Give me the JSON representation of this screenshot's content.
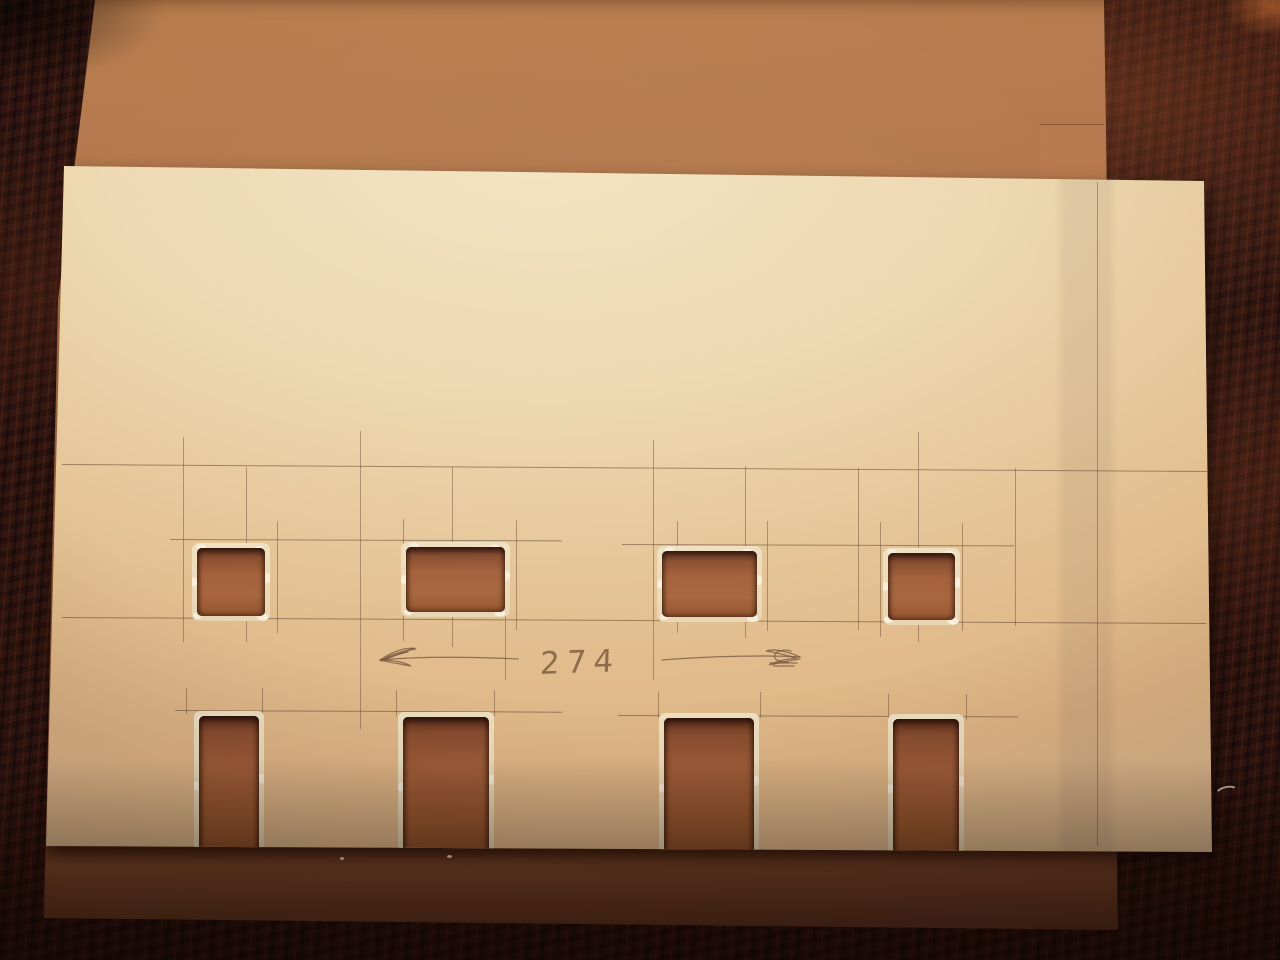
{
  "meta": {
    "type": "photograph",
    "subject": "Scratch-built model facade wall cut from a white styrene sheet, with four window openings and four door openings, lying on an MDF board on a dark wooden workbench"
  },
  "annotations": {
    "dimension_label": "274",
    "dimension_arrows": "pencil dimension arrows pointing left and right around the measurement"
  },
  "objects": {
    "workbench": {
      "label": "dark wooden workbench",
      "color": "#2b1310"
    },
    "mdf_board": {
      "label": "MDF backing board",
      "color": "#a96b43"
    },
    "facade_sheet": {
      "label": "white styrene facade sheet",
      "color": "#e7cda4"
    },
    "window_openings": {
      "count": 4
    },
    "door_openings": {
      "count": 4
    }
  }
}
